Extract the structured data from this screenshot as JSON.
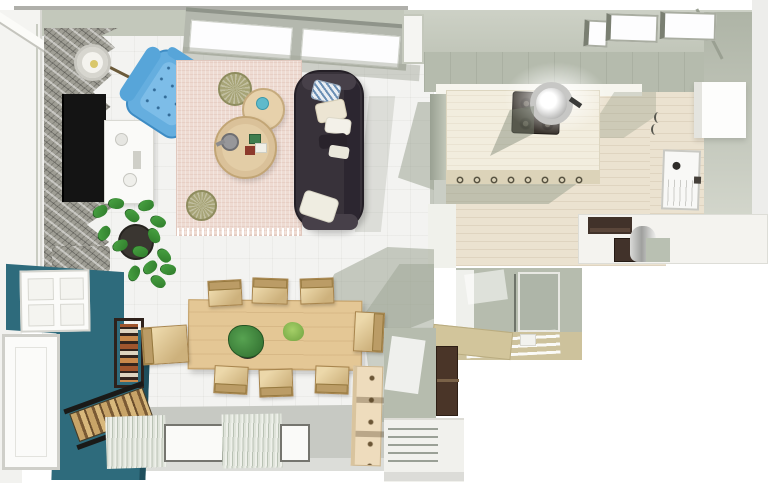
{
  "scene": {
    "description": "Top-down 3D rendering of an open-plan apartment: living room, dining area, kitchen, and partial utility/bath rooms",
    "rooms": [
      {
        "name": "living-room",
        "objects": [
          "stone accent wall",
          "wall-mounted TV",
          "white media console",
          "floor lamp",
          "blue tufted armchair",
          "pink area rug with fringe",
          "round nesting coffee tables",
          "blue cup",
          "gray teapot",
          "green and red boxes",
          "two olive poufs",
          "dark gray sofa",
          "throw pillows",
          "monstera plants",
          "stone planter",
          "slanted double window"
        ]
      },
      {
        "name": "dining-area",
        "objects": [
          "light wood dining table",
          "eight beige chairs",
          "potted plant centerpiece",
          "small green plant",
          "teal accent wall",
          "white paneled door",
          "dark wood shelf with books",
          "firewood rack",
          "open white door",
          "tall wooden peg shelf",
          "two windows with curtains"
        ]
      },
      {
        "name": "kitchen",
        "objects": [
          "wood island counter",
          "black cooktop",
          "steel pot with glare",
          "scroll-back stools",
          "white counter",
          "dark microwave",
          "dark oven",
          "steel bin",
          "sage cabinet",
          "white door with peephole",
          "white wall cabinet",
          "three skylights",
          "wall hooks"
        ]
      },
      {
        "name": "bath-fragment",
        "objects": [
          "gray-green walls",
          "tan floor",
          "white drying rack"
        ]
      },
      {
        "name": "utility-corner",
        "objects": [
          "gray-green wall",
          "tan counter",
          "dark brown cabinet",
          "white vented base unit"
        ]
      }
    ]
  },
  "colors": {
    "canvas-bg": "#ffffff",
    "wall-band": "#c3c8bb",
    "wall-tile": "#b5bbad",
    "floor-tile": "#f3f3f1",
    "floor-wood": "#ebe2d0",
    "stone-wall": "#9e9d94",
    "tv-screen": "#141414",
    "teal-wall": "#2e6b7c",
    "sofa": "#38323a",
    "armchair": "#65aedf",
    "rug": "#eedbd2",
    "table-wood": "#e4c795",
    "chair": "#cdb17c",
    "pouf": "#a7a477",
    "plant": "#4aa544",
    "cooktop": "#39332d",
    "appliance": "#41322a",
    "bath-floor": "#cdc29c",
    "curtain": "#c9d0c4",
    "shadow": "rgba(150,158,140,0.5)"
  }
}
